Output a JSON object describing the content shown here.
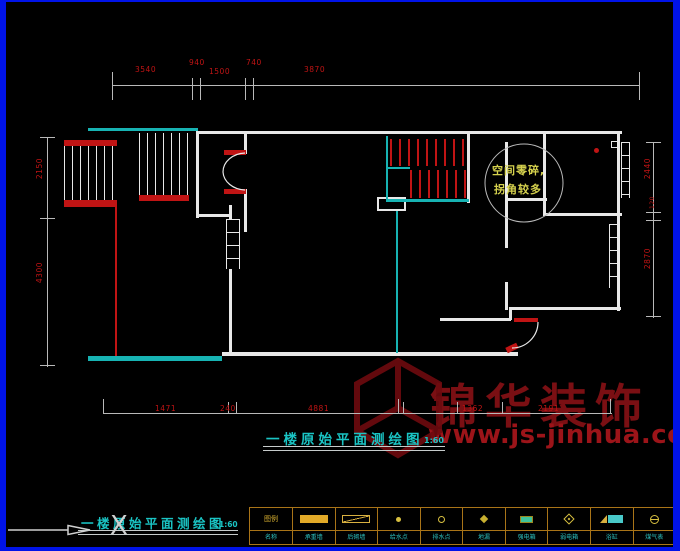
{
  "titles": {
    "main": "一楼原始平面测绘图",
    "main_scale": "1:60",
    "secondary": "一楼原始平面测绘图",
    "secondary_scale": "1:60"
  },
  "annotation_bubble": {
    "line1": "空间零碎,",
    "line2": "拐角较多"
  },
  "ucs": {
    "x_label": "X"
  },
  "watermark": {
    "brand": "锦华装饰",
    "url": "www.js-jinhua.com"
  },
  "dimensions": {
    "top": [
      "3540",
      "940",
      "1500",
      "740",
      "3870"
    ],
    "bottom": [
      "1471",
      "240",
      "4881",
      "1362",
      "2191"
    ],
    "left": [
      "2150",
      "4300"
    ],
    "right": [
      "2440",
      "120",
      "2870"
    ]
  },
  "legend": {
    "corner_top": "图例",
    "corner_bottom": "名称",
    "items": [
      {
        "icon": "solid-wall-icon",
        "label": "承重墙"
      },
      {
        "icon": "partition-wall-icon",
        "label": "后砌墙"
      },
      {
        "icon": "water-point-icon",
        "label": "给水点"
      },
      {
        "icon": "drain-point-icon",
        "label": "排水点"
      },
      {
        "icon": "floor-drain-icon",
        "label": "地漏"
      },
      {
        "icon": "power-box-icon",
        "label": "强电箱"
      },
      {
        "icon": "weak-box-icon",
        "label": "弱电箱"
      },
      {
        "icon": "bathtub-icon",
        "label": "浴缸"
      },
      {
        "icon": "gas-meter-icon",
        "label": "煤气表"
      }
    ]
  },
  "colors": {
    "frame_blue": "#0013e8",
    "wall_white": "#e8e8e8",
    "cad_red": "#c01414",
    "cad_cyan": "#17b3b3",
    "annotation_yellow": "#d6d24e",
    "watermark_red": "#7a0f13",
    "legend_grid": "#a97418"
  }
}
